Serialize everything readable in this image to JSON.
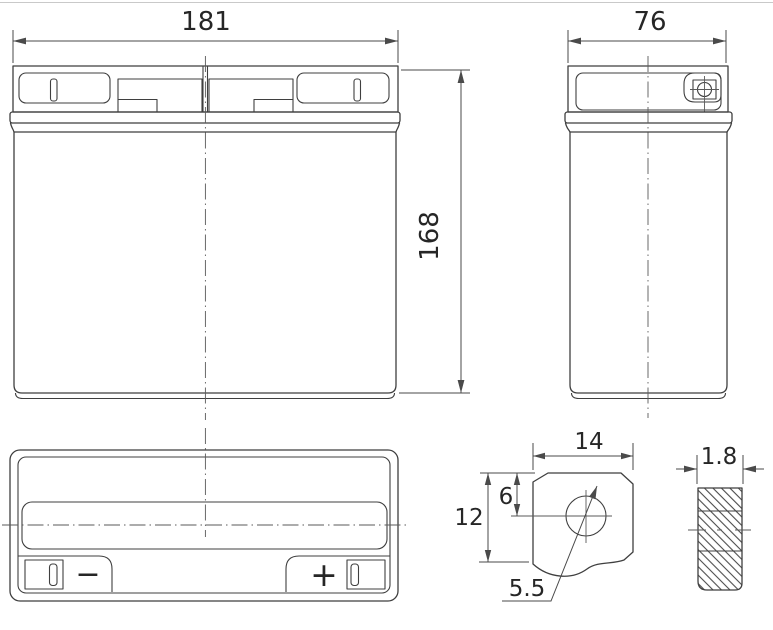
{
  "page": {
    "background": "#ffffff",
    "top_border_color": "#c9c9c9",
    "line_color": "#3f3f3f",
    "text_color": "#262626"
  },
  "drawing": {
    "type": "battery-dimensional-drawing",
    "front_view": {
      "width_dim": "181",
      "height_dim": "168"
    },
    "side_view": {
      "width_dim": "76"
    },
    "top_view": {
      "negative_terminal_symbol": "−",
      "positive_terminal_symbol": "+"
    },
    "terminal_detail": {
      "width_dim": "14",
      "hole_center_dim": "6",
      "height_dim": "12",
      "hole_diameter_dim": "5.5"
    },
    "terminal_section": {
      "thickness_dim": "1.8"
    }
  }
}
